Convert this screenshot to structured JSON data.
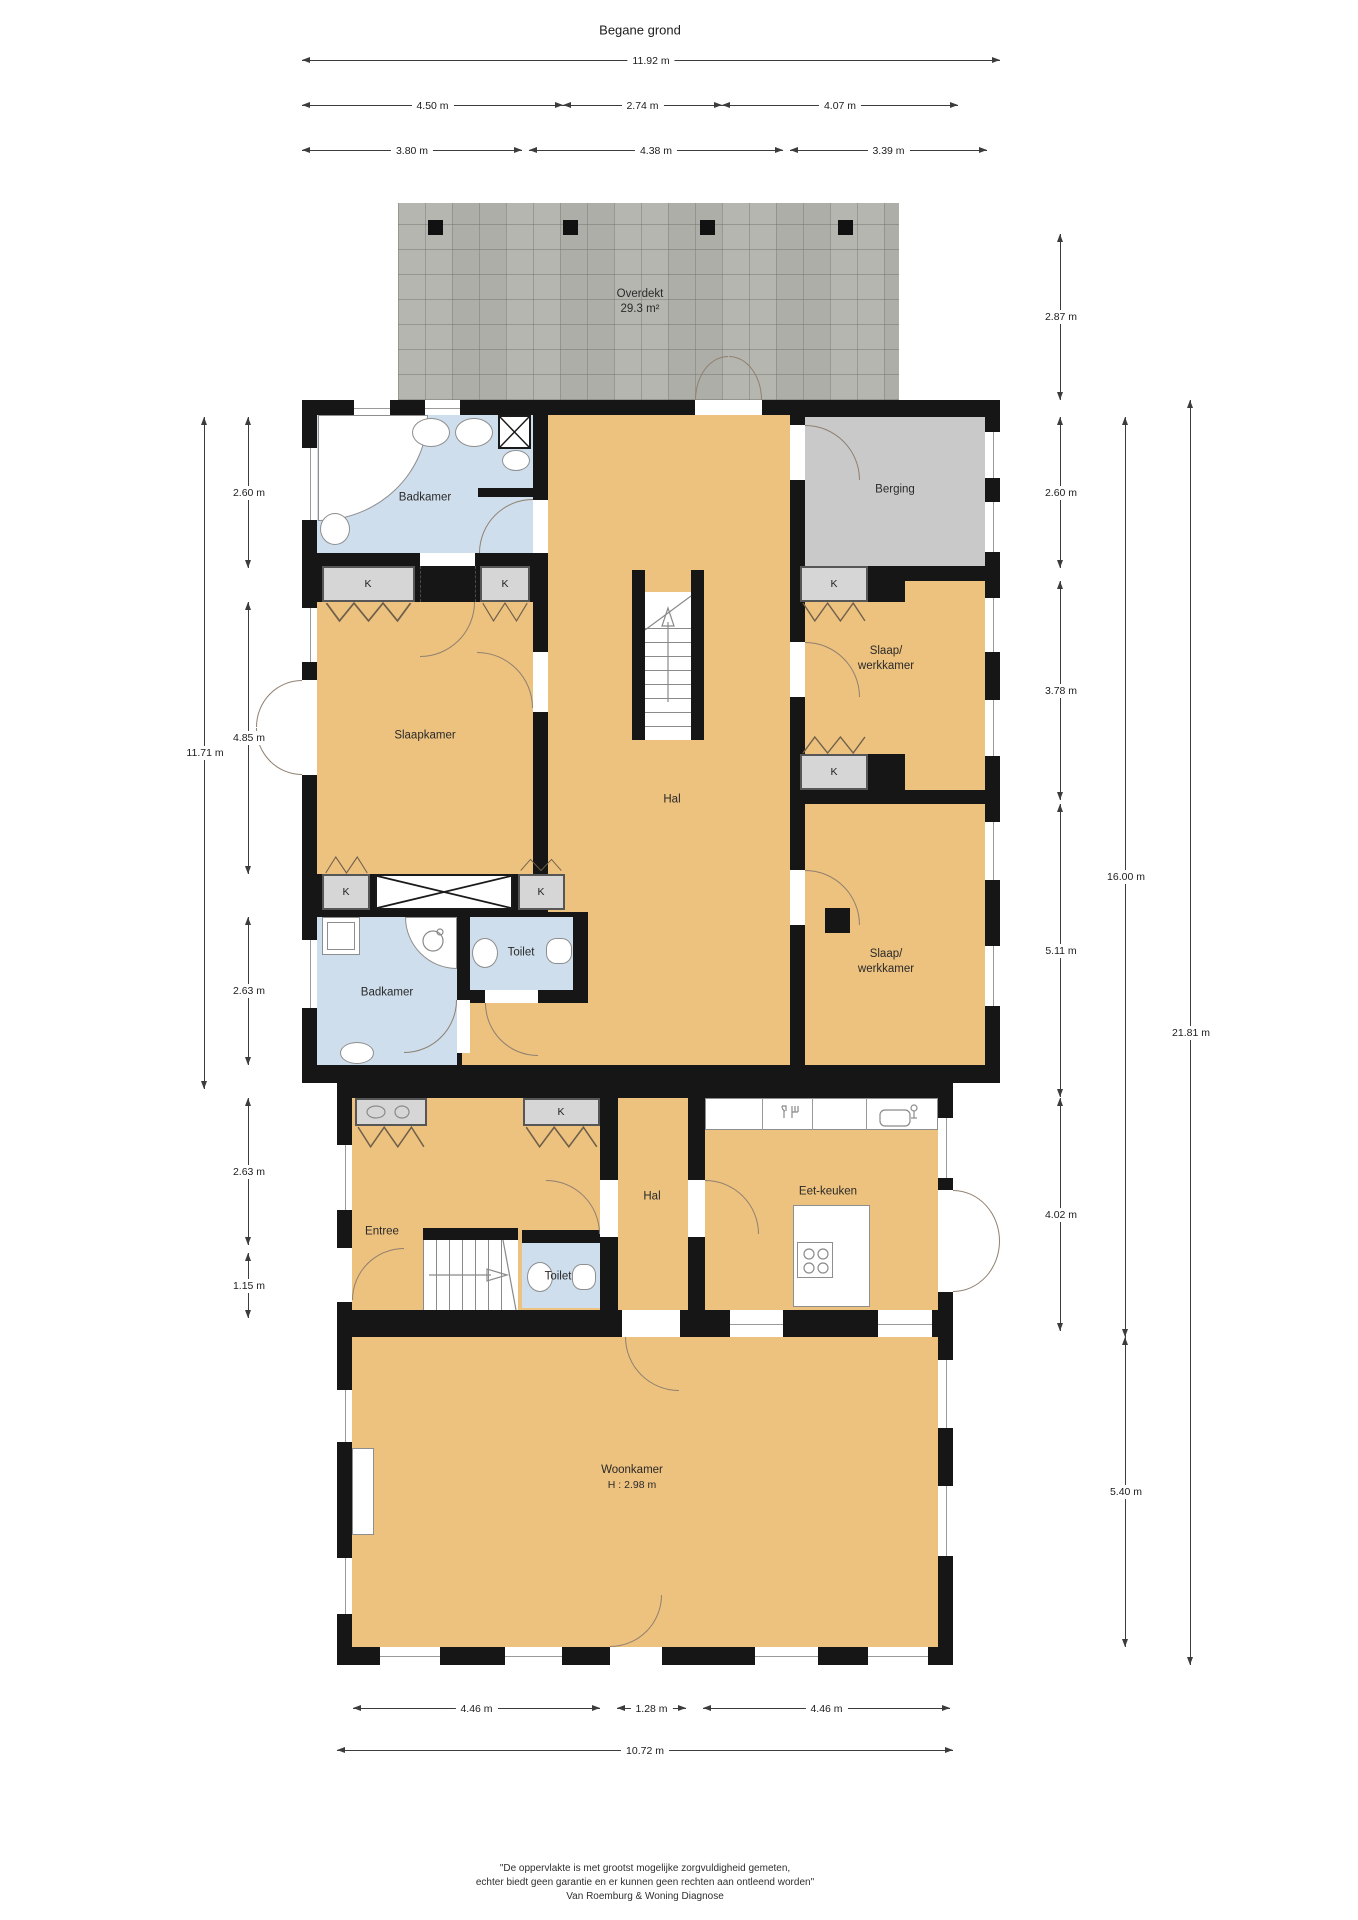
{
  "title": "Begane grond",
  "dims": {
    "top": [
      "11.92 m",
      "4.50 m",
      "2.74 m",
      "4.07 m",
      "3.80 m",
      "4.38 m",
      "3.39 m"
    ],
    "left": [
      "2.60 m",
      "11.71 m",
      "4.85 m",
      "2.63 m",
      "2.63 m",
      "1.15 m"
    ],
    "right": [
      "2.87 m",
      "2.60 m",
      "3.78 m",
      "5.11 m",
      "16.00 m",
      "21.81 m",
      "4.02 m",
      "5.40 m"
    ],
    "bottom": [
      "4.46 m",
      "1.28 m",
      "4.46 m",
      "10.72 m"
    ]
  },
  "rooms": {
    "overdekt": {
      "name": "Overdekt",
      "area": "29.3 m²"
    },
    "badkamer1": "Badkamer",
    "berging": "Berging",
    "slaapkamer": "Slaapkamer",
    "slaapwerk": {
      "l1": "Slaap/",
      "l2": "werkkamer"
    },
    "hal1": "Hal",
    "toilet1": "Toilet",
    "badkamer2": "Badkamer",
    "entree": "Entree",
    "hal2": "Hal",
    "toilet2": "Toilet",
    "eetkeuken": "Eet-keuken",
    "woonkamer": {
      "name": "Woonkamer",
      "height": "H : 2.98 m"
    },
    "closet": "K"
  },
  "footer": {
    "line1": "\"De oppervlakte is met grootst mogelijke zorgvuldigheid gemeten,",
    "line2": "echter biedt geen garantie en er kunnen geen rechten aan ontleend worden\"",
    "line3": "Van Roemburg & Woning Diagnose"
  },
  "colors": {
    "floor": "#EDC17E",
    "wet_room": "#CEDEEC",
    "storage": "#C9C9C9",
    "wall": "#161616",
    "closet": "#D6D6D6",
    "roof": "#B2B2AE"
  }
}
